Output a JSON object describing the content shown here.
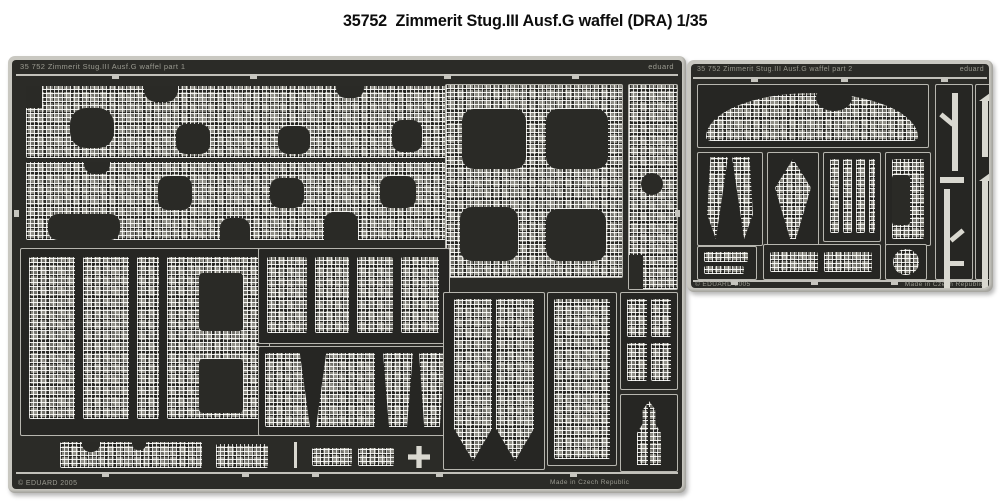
{
  "title": {
    "number": "35752",
    "text": "Zimmerit Stug.III Ausf.G waffel  (DRA) 1/35"
  },
  "fret_large": {
    "header_label": "35 752  Zimmerit Stug.III Ausf.G waffel    part 1",
    "brand": "eduard",
    "copyright": "© EDUARD 2005",
    "made_in": "Made in Czech Republic"
  },
  "fret_small": {
    "header_label": "35 752  Zimmerit Stug.III Ausf.G waffel    part 2",
    "brand": "eduard",
    "copyright": "© EDUARD 2005",
    "made_in": "Made in Czech Republic"
  },
  "colors": {
    "page_background": "#ffffff",
    "fret_plate_dark": "#2b2b27",
    "fret_frame_light": "#c9c8c1",
    "etched_text": "#9a9a90",
    "zimmerit_texture_light": "#d9d8d0",
    "title_text": "#0d0d0d"
  }
}
